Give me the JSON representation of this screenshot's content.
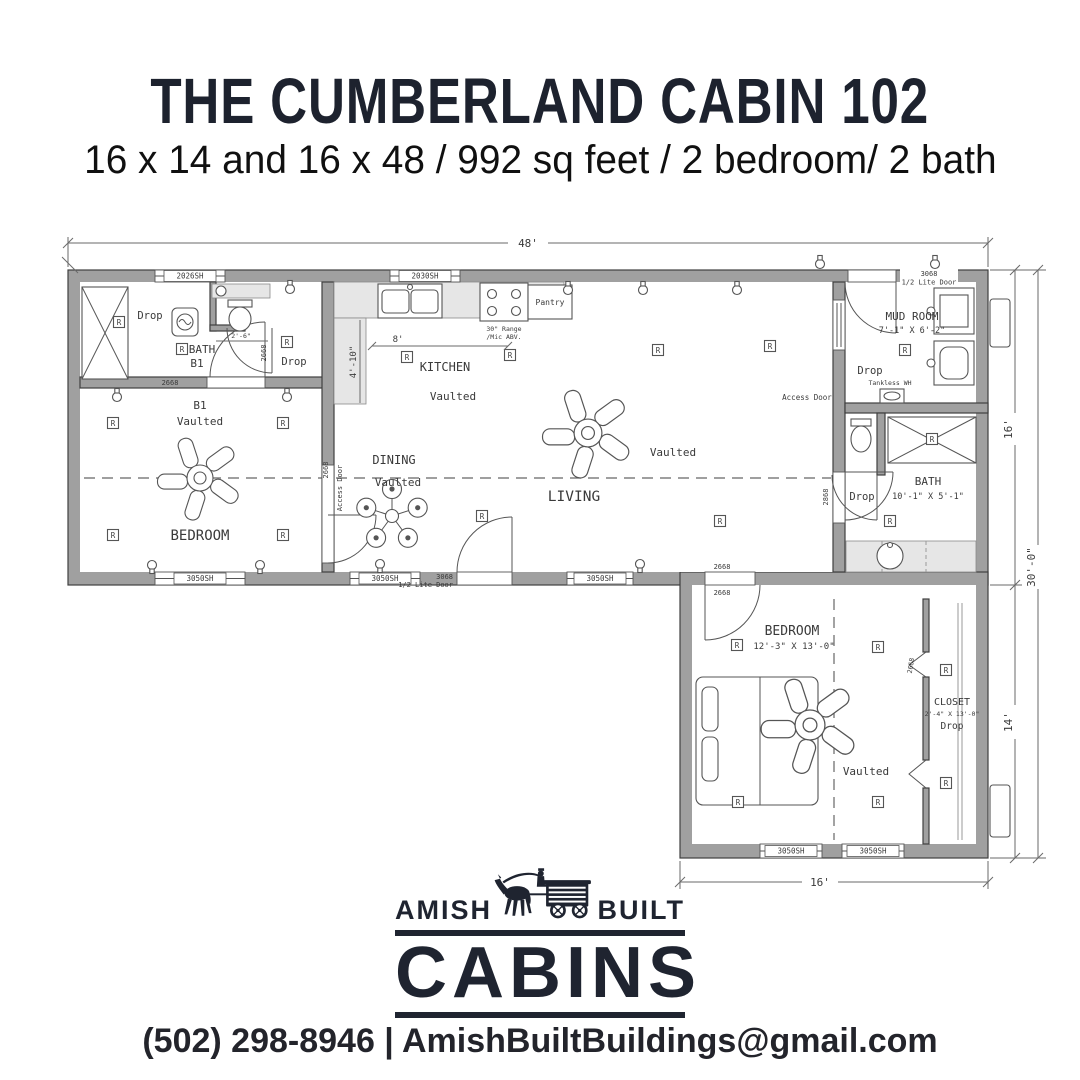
{
  "header": {
    "title": "THE CUMBERLAND CABIN 102",
    "subtitle": "16 x 14 and 16 x 48 / 992 sq feet / 2 bedroom/ 2 bath"
  },
  "plan": {
    "dims": {
      "top": "48'",
      "right_upper": "16'",
      "right_overall": "30'-0\"",
      "right_lower": "14'",
      "bottom": "16'",
      "kitchen_w": "8'",
      "kitchen_d": "4'-10\"",
      "bath1": "2'-6\""
    },
    "rooms": {
      "bath1": "BATH",
      "bath1_sub": "B1",
      "b1": "B1",
      "bedroom1": "BEDROOM",
      "kitchen": "KITCHEN",
      "dining": "DINING",
      "living": "LIVING",
      "mudroom": "MUD ROOM",
      "mudroom_size": "7'-1\" X 6'-2\"",
      "bath2": "BATH",
      "bath2_size": "10'-1\" X 5'-1\"",
      "bedroom2": "BEDROOM",
      "bedroom2_size": "12'-3\" X 13'-0\"",
      "closet": "CLOSET",
      "closet_size": "2'-4\" X 13'-0\"",
      "vaulted": "Vaulted",
      "drop": "Drop"
    },
    "fixtures": {
      "range1": "30\" Range",
      "range2": "/Mic ABV.",
      "pantry": "Pantry",
      "tankless": "Tankless WH",
      "access_door": "Access Door"
    },
    "openings": {
      "w2026": "2026SH",
      "w2030": "2030SH",
      "w3050": "3050SH",
      "d3068": "3068",
      "d3068_sub": "1/2 Lite Door",
      "d2668": "2668",
      "d2868": "2868"
    },
    "receptacle": "R"
  },
  "logo": {
    "amish": "AMISH",
    "built": "BUILT",
    "cabins": "CABINS"
  },
  "footer": {
    "contact": "(502) 298-8946 | AmishBuiltBuildings@gmail.com"
  }
}
